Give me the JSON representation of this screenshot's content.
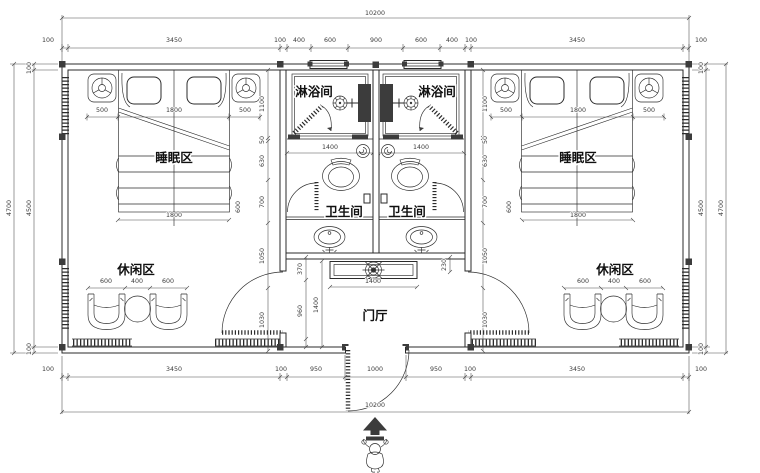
{
  "colors": {
    "line": "#2b2b2b",
    "dim": "#4a4a4a",
    "paper": "#ffffff",
    "solid_fill": "#3c3c3c"
  },
  "labels": {
    "shower": "淋浴间",
    "sleep": "睡眠区",
    "toilet": "卫生间",
    "leisure": "休闲区",
    "foyer": "门厅"
  },
  "dims": {
    "overall": "10200",
    "top_chain": [
      "100",
      "3450",
      "100",
      "400",
      "600",
      "900",
      "600",
      "400",
      "100",
      "3450",
      "100"
    ],
    "bottom_chain": [
      "100",
      "3450",
      "100",
      "950",
      "1000",
      "950",
      "100",
      "3450",
      "100"
    ],
    "side": {
      "outer": "4700",
      "inner": "4500",
      "wall": "100"
    },
    "bed": {
      "side": "500",
      "width": "1800",
      "length": "1800",
      "foot": "600"
    },
    "leisure": {
      "chair": "600",
      "table": "400"
    },
    "bath_width": "1400",
    "console_width": "1400",
    "foyer": {
      "front": "370",
      "hall": "960",
      "depth": "1400",
      "niche": "230"
    },
    "wall_chain": [
      "1100",
      "50",
      "630",
      "700",
      "1050",
      "1030"
    ]
  },
  "icons": {
    "lamp": "circle-with-spokes",
    "floor_drain": "crosshair-circle",
    "ceiling_lamp": "cross-circle",
    "entrance_arrow": "filled-up-arrow",
    "person": "human-figure"
  }
}
